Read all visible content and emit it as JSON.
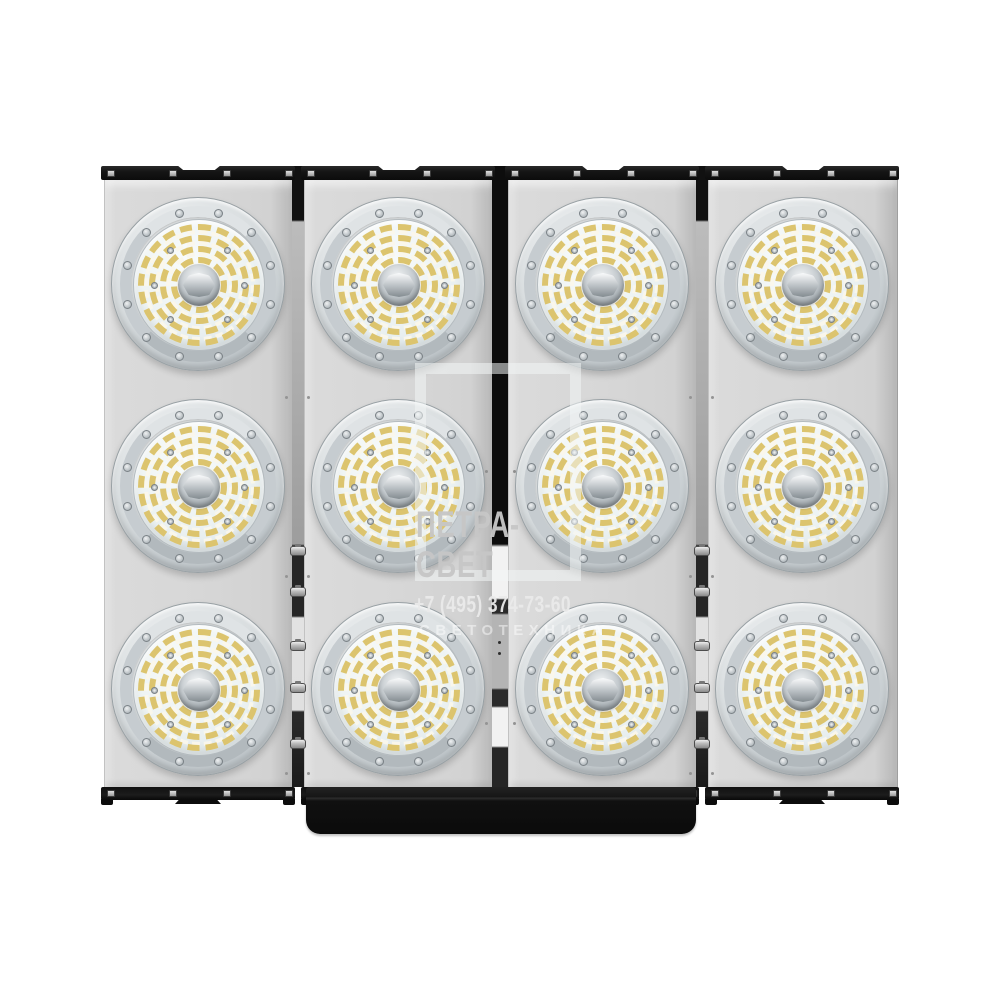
{
  "meta": {
    "description": "Product photo of an LED floodlight: four vertical panels, each with three round LED modules (12 modules total), black mounting rails and bottom bracket, on a white background",
    "background": "#ffffff"
  },
  "watermark": {
    "brand_line1": "ПЕТРА-",
    "brand_line2": "СВЕТ",
    "phone": "+7 (495) 374-73-60",
    "subtitle": "СВЕТОТЕХНИКА"
  },
  "fixture": {
    "panel_count": 4,
    "module_rows": 3,
    "module_total": 12
  },
  "colors": {
    "panel_gray": "#d6d6d6",
    "frame_black": "#141414",
    "led_yellow": "#dcc46e",
    "led_white": "#f5f2e4",
    "metal_silver": "#c6ccd0",
    "lens_bg": "#eaf0f0",
    "watermark_text": "#c6c6c6",
    "watermark_phone": "#eaeaea"
  }
}
